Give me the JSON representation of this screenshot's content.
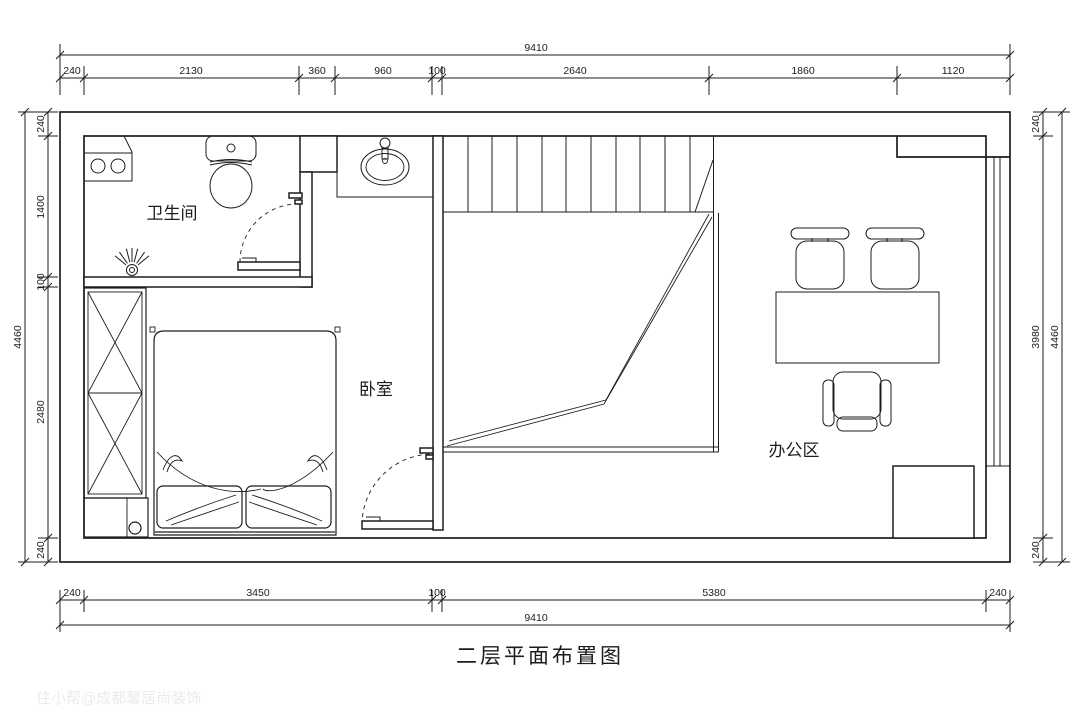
{
  "title": "二层平面布置图",
  "watermark": "住小帮@成都馨居尚装饰",
  "rooms": {
    "bathroom": "卫生间",
    "bedroom": "卧室",
    "office": "办公区"
  },
  "dims": {
    "top": {
      "total": "9410",
      "segments": [
        "240",
        "2130",
        "360",
        "960",
        "100",
        "2640",
        "1860",
        "1120"
      ]
    },
    "bottom": {
      "total": "9410",
      "segments": [
        "240",
        "3450",
        "100",
        "5380",
        "240"
      ]
    },
    "left": {
      "total": "4460",
      "segments": [
        "240",
        "1400",
        "100",
        "2480",
        "240"
      ]
    },
    "right": {
      "total": "4460",
      "segments": [
        "240",
        "3980",
        "240"
      ]
    }
  }
}
